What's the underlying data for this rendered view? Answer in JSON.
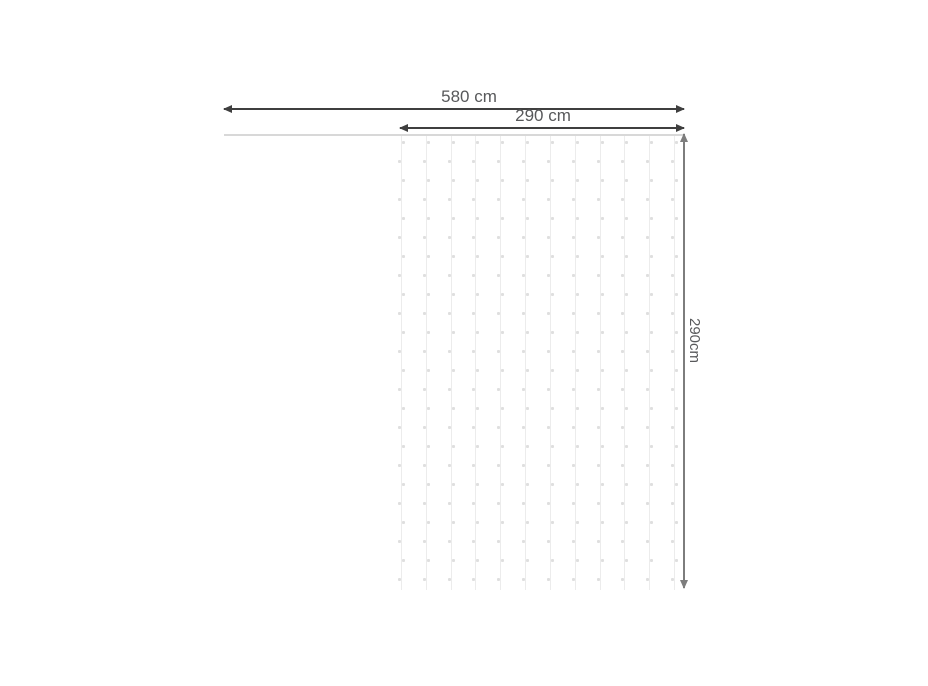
{
  "diagram": {
    "title": "light-curtain-dimension-diagram",
    "labels": {
      "total_width": "580 cm",
      "curtain_width": "290 cm",
      "curtain_height": "290cm"
    },
    "curtain": {
      "strings": 12,
      "lights_per_string": 24
    },
    "colors": {
      "label_text": "#58595b",
      "dim_arrow_dark": "#3f3f3f",
      "dim_arrow_gray": "#7d7d7d",
      "wire": "#d8d8d8",
      "string": "#ececec",
      "light_dot": "#dfdfdf",
      "background": "#ffffff"
    }
  }
}
